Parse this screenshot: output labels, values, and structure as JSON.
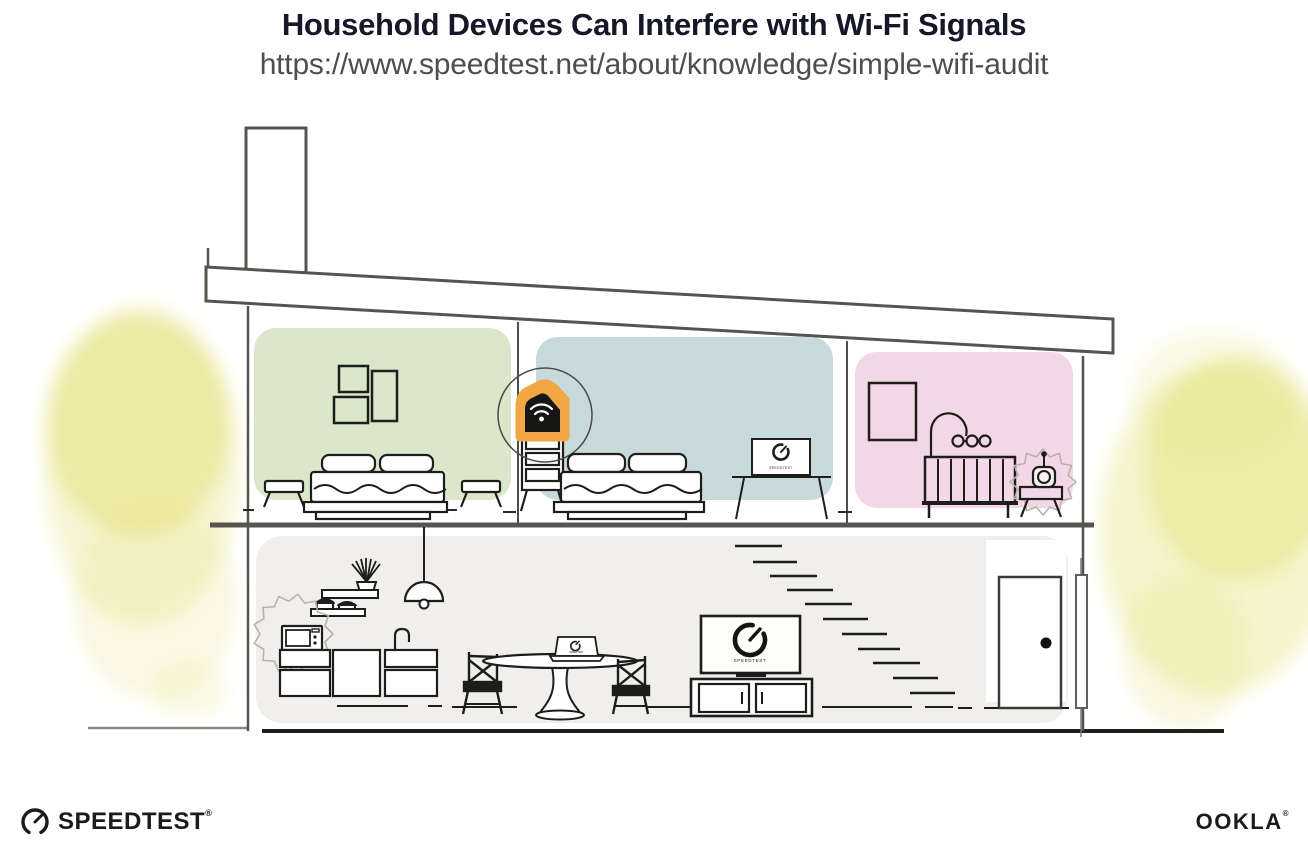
{
  "header": {
    "title": "Household Devices Can Interfere with Wi-Fi Signals",
    "subtitle_url": "https://www.speedtest.net/about/knowledge/simple-wifi-audit"
  },
  "branding": {
    "speedtest_logo_text": "SPEEDTEST",
    "speedtest_reg_mark": "®",
    "ookla_logo_text": "OOKLA",
    "ookla_reg_mark": "®"
  },
  "illustration": {
    "screen_label": "SPEEDTEST",
    "colors": {
      "green_room_wall": "#dbe7ca",
      "blue_room_wall": "#c8d9dc",
      "pink_room_wall": "#f3d7e6",
      "downstairs_wall": "#f1efeb",
      "router_highlight_orange": "#f2a644",
      "foliage_yellow": "#e6e17b",
      "structure_gray": "#55544f",
      "ink_black": "#1d1d1b"
    }
  }
}
